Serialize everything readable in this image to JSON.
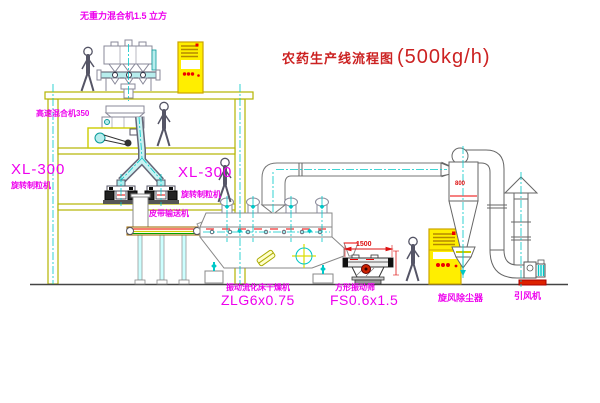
{
  "title": {
    "cn": "农药生产线流程图",
    "capacity": "(500kg/h)"
  },
  "labels": {
    "gravity_mixer": "无重力混合机1.5 立方",
    "high_speed_mixer": "高速混合机350",
    "granulator_left_model": "XL-300",
    "granulator_left_name": "旋转制粒机",
    "granulator_right_model": "XL-300",
    "granulator_right_name": "旋转制粒机",
    "belt_conveyor": "皮带输送机",
    "dryer_name": "振动流化床干燥机",
    "dryer_model": "ZLG6x0.75",
    "screen_name": "方形振动筛",
    "screen_model": "FS0.6x1.5",
    "cyclone": "旋风除尘器",
    "fan": "引风机"
  },
  "dimensions": {
    "screen_length": "1500",
    "cyclone_dia": "800"
  },
  "colors": {
    "label_magenta": "#ee00ee",
    "title_red": "#cc2222",
    "dimension_red": "#dd1111",
    "equipment_yellow": "#b5b500",
    "centerline_cyan": "#00c8c8",
    "cabinet_yellow": "#ffee00",
    "base_red": "#dd2200"
  }
}
